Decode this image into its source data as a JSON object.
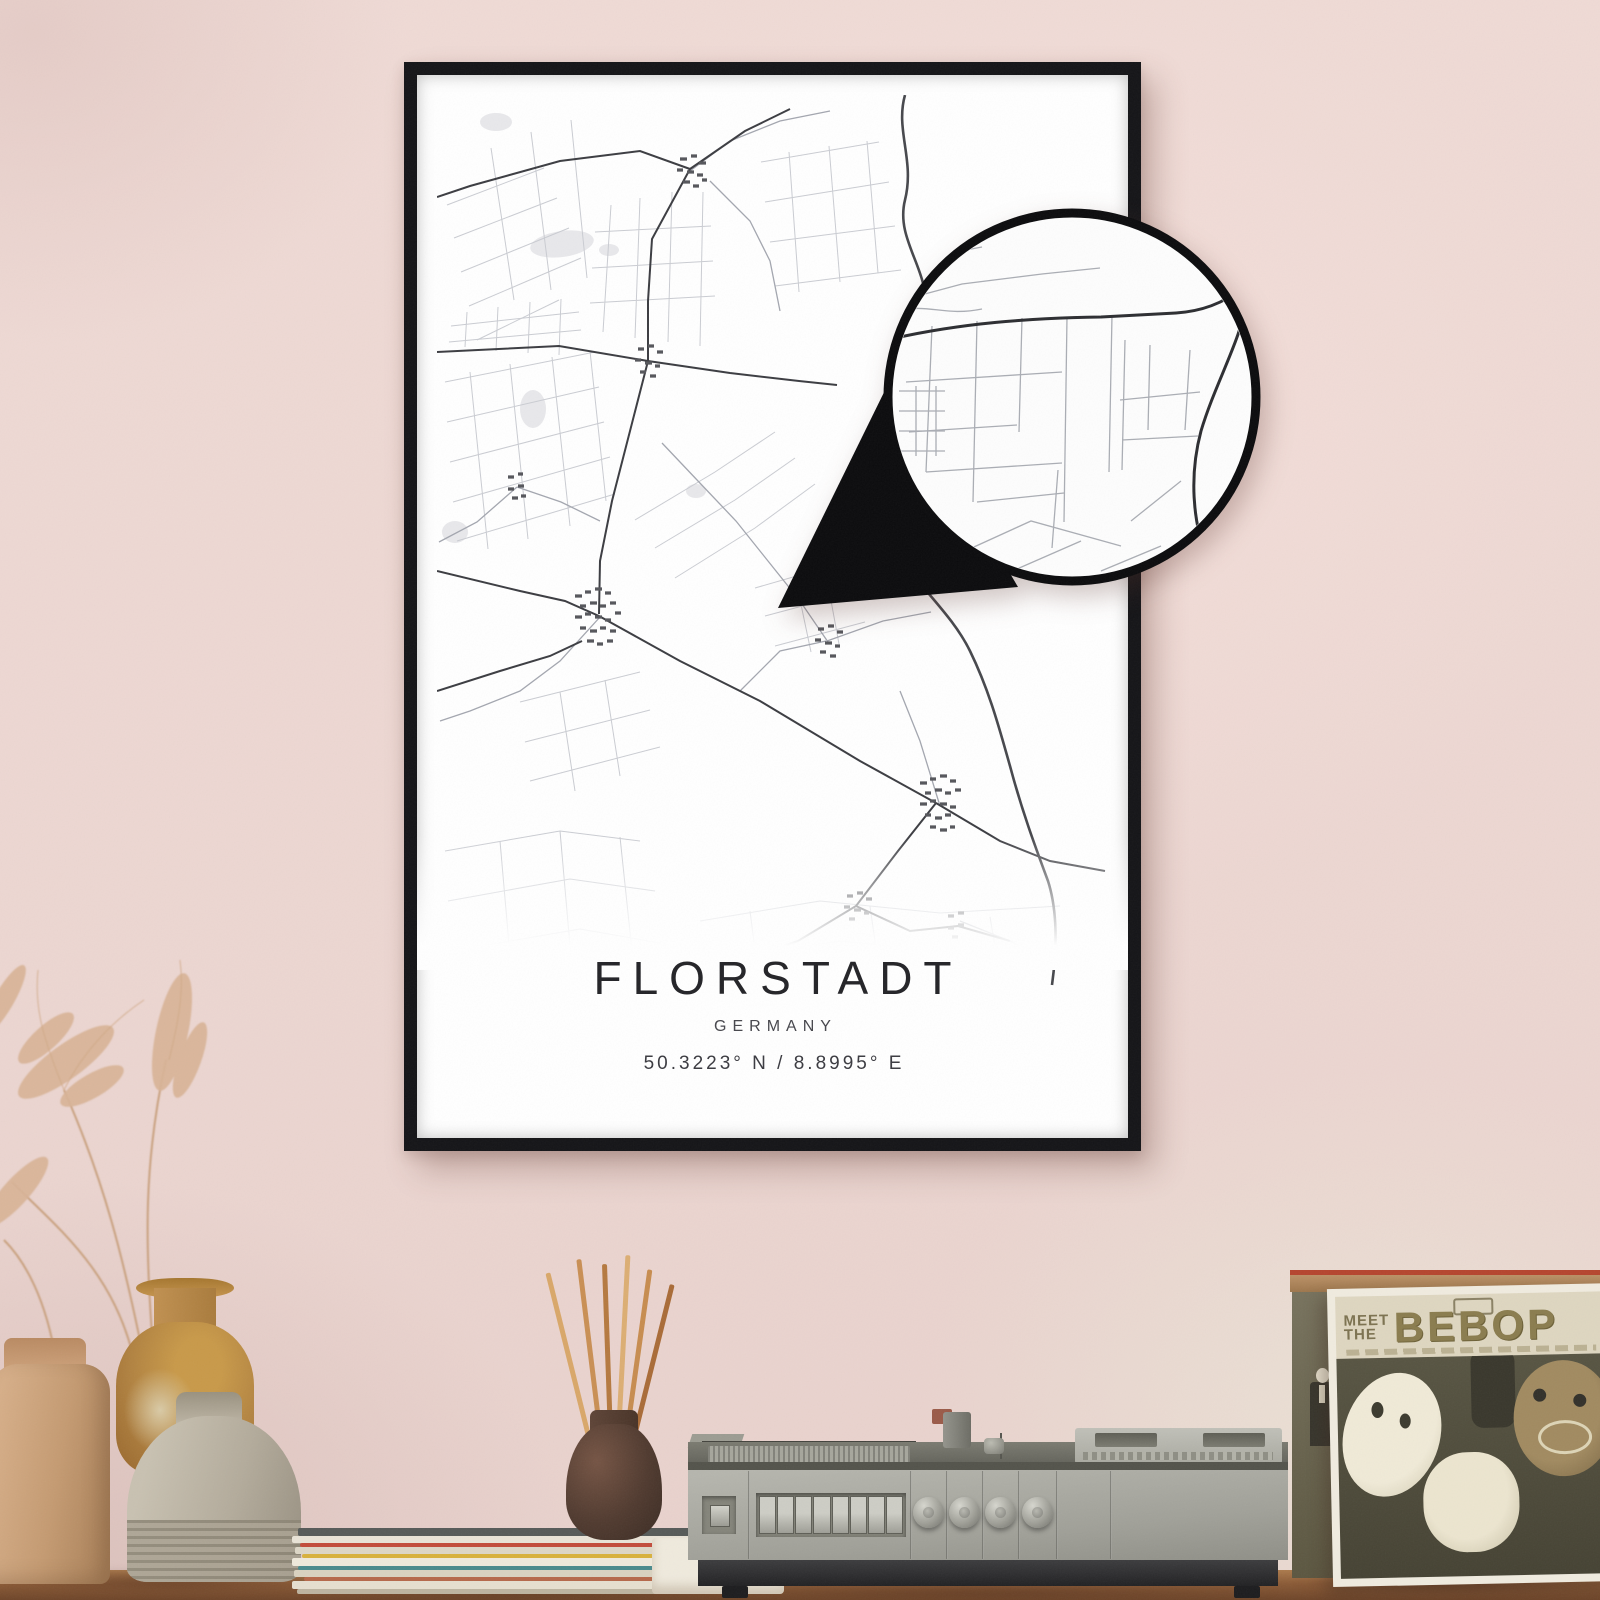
{
  "poster": {
    "title": "FLORSTADT",
    "subtitle": "GERMANY",
    "coordinates": "50.3223° N / 8.8995° E"
  },
  "record_sleeve": {
    "meet": "MEET",
    "the": "THE",
    "title": "BEBOP"
  },
  "icons": {
    "zoom_detail": "magnifier-circle",
    "zoom_pointer": "magnifier-tail-triangle"
  },
  "colors": {
    "wall_pink": "#ecd6d1",
    "frame_black": "#141417",
    "map_main_road": "#3b3c41",
    "map_minor_road": "#caccd2",
    "map_river": "#46474c",
    "sleeve_gold": "#8a7c4e",
    "table_wood": "#8a5a36",
    "player_gray": "#a9a9a1",
    "reed_tan": "#d9a769"
  }
}
